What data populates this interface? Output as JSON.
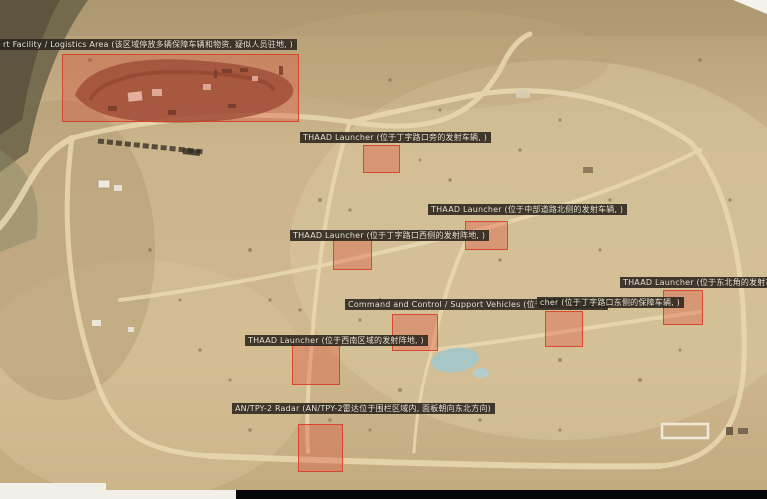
{
  "colors": {
    "annotation_box_fill": "#E14632",
    "annotation_box_border": "#D93A26",
    "label_background": "#2A241C",
    "label_text": "#EFE8D6",
    "terrain_sand": "#C9B189",
    "road": "#EAD9B2",
    "letterbox_bar": "#070707",
    "edge_strip": "#F2EFE8"
  },
  "annotations": [
    {
      "id": "support-facility-logistics-area",
      "label": "rt Facility / Logistics Area (该区域停放多辆保障车辆和物资, 疑似人员驻地, )",
      "label_x": 0,
      "label_y": 39,
      "box": {
        "x": 62,
        "y": 54,
        "w": 237,
        "h": 68
      }
    },
    {
      "id": "thaad-launcher-north",
      "label": "THAAD Launcher (位于丁字路口旁的发射车辆, )",
      "label_x": 300,
      "label_y": 132,
      "box": {
        "x": 363,
        "y": 145,
        "w": 37,
        "h": 28
      }
    },
    {
      "id": "thaad-launcher-center-east",
      "label": "THAAD Launcher (位于中部道路北侧的发射车辆, )",
      "label_x": 428,
      "label_y": 204,
      "box": {
        "x": 465,
        "y": 221,
        "w": 43,
        "h": 29
      }
    },
    {
      "id": "thaad-launcher-center-west",
      "label": "THAAD Launcher (位于丁字路口西侧的发射阵地, )",
      "label_x": 290,
      "label_y": 230,
      "box": {
        "x": 333,
        "y": 237,
        "w": 39,
        "h": 33
      }
    },
    {
      "id": "command-control-support-vehicles",
      "label": "Command and Control / Support Vehicles (位于路口的保障车辆)",
      "label_x": 345,
      "label_y": 299,
      "box": {
        "x": 392,
        "y": 314,
        "w": 46,
        "h": 37
      }
    },
    {
      "id": "launcher-east",
      "label": "cher (位于丁字路口东侧的保障车辆, )",
      "label_x": 537,
      "label_y": 297,
      "box": {
        "x": 545,
        "y": 311,
        "w": 38,
        "h": 36
      }
    },
    {
      "id": "thaad-launcher-northeast",
      "label": "THAAD Launcher (位于东北角的发射车辆, )",
      "label_x": 620,
      "label_y": 277,
      "box": {
        "x": 663,
        "y": 290,
        "w": 40,
        "h": 35
      }
    },
    {
      "id": "thaad-launcher-southwest",
      "label": "THAAD Launcher (位于西南区域的发射阵地, )",
      "label_x": 245,
      "label_y": 335,
      "box": {
        "x": 292,
        "y": 345,
        "w": 48,
        "h": 40
      }
    },
    {
      "id": "an-tpy-2-radar",
      "label": "AN/TPY-2 Radar (AN/TPY-2雷达位于围栏区域内, 面板朝向东北方向)",
      "label_x": 232,
      "label_y": 403,
      "box": {
        "x": 298,
        "y": 424,
        "w": 45,
        "h": 48
      }
    }
  ]
}
